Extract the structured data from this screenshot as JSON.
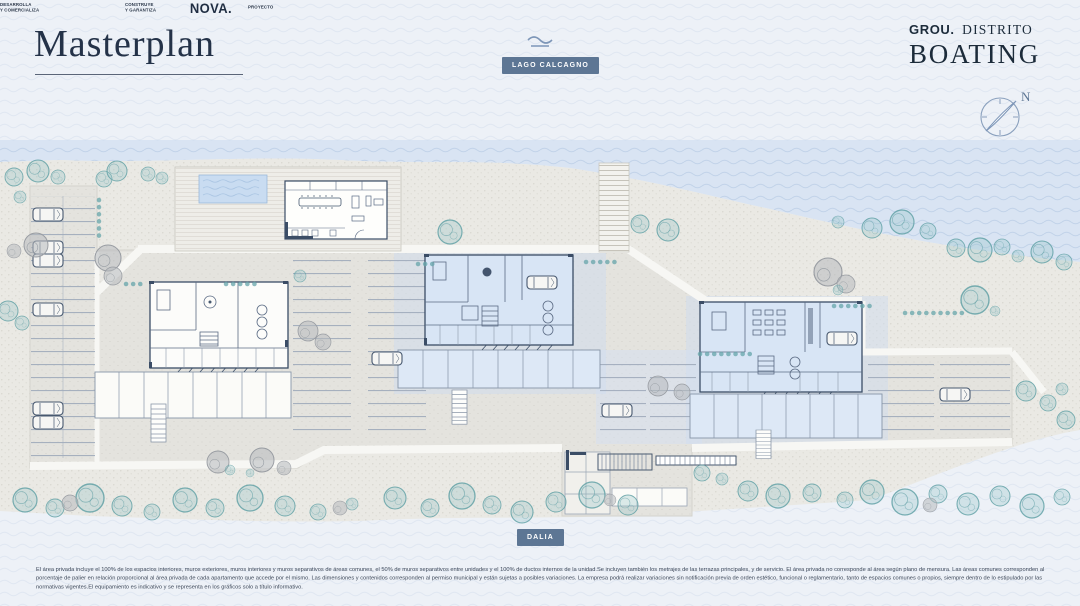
{
  "header": {
    "title": "Masterplan",
    "lake_badge": "LAGO CALCAGNO",
    "brand_bold": "GROU.",
    "brand_serif": "DISTRITO",
    "brand_line2": "BOATING",
    "compass_north": "N"
  },
  "plan": {
    "street_badge": "DALIA",
    "buildings": [
      {
        "id": "building-west",
        "highlighted": false
      },
      {
        "id": "building-center",
        "highlighted": true
      },
      {
        "id": "building-east",
        "highlighted": true
      }
    ]
  },
  "footer": {
    "credits": [
      {
        "role_line1": "DESARROLLA",
        "role_line2": "Y COMERCIALIZA",
        "logo": "GROU."
      },
      {
        "role_line1": "CONSTRUYE",
        "role_line2": "Y GARANTIZA",
        "logo": "NOVA."
      },
      {
        "role_line1": "PROYECTO",
        "role_line2": "",
        "logo": "SITIO",
        "logo_sup": "ARQ"
      }
    ],
    "disclaimer": "El área privada incluye el 100% de los espacios interiores, muros exteriores, muros interiores y muros separativos de áreas comunes, el 50% de muros separativos entre unidades y el 100% de ductos internos de la unidad.Se incluyen también los metrajes de las terrazas principales, y de servicio. El área privada no corresponde al área según plano de mensura. Las áreas comunes corresponden al porcentaje de palier en relación proporcional al área privada de cada apartamento que accede por el mismo. Las dimensiones y contenidos corresponden al permiso municipal y están sujetas a posibles variaciones. La empresa podrá realizar variaciones sin notificación previa de orden estético, funcional o reglamentario, tanto de espacios comunes o propios, siempre dentro de lo estipulado por las normativas vigentes.El equipamiento es indicativo y se representa en los gráficos solo a título informativo."
  },
  "colors": {
    "badge_bg": "#5d7694",
    "ink": "#20304a",
    "water": "#d9e4f3",
    "land": "#eae9e4",
    "plat": "#e4e3de",
    "highlight": "#d8e5f5",
    "outline": "#3b4d66",
    "tree": "#5b9da3"
  }
}
